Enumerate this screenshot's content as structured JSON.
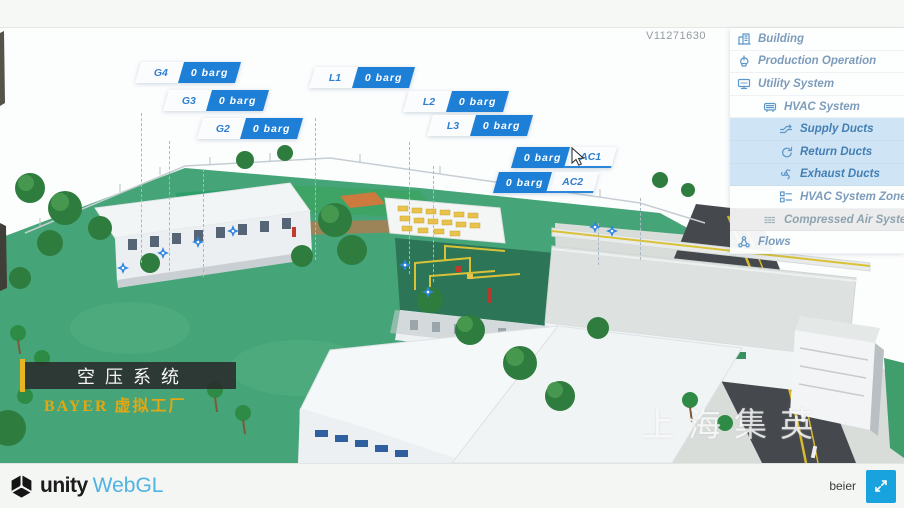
{
  "header": {
    "version": "V11271630"
  },
  "sidebar": {
    "items": [
      {
        "label": "Building",
        "icon": "building-icon",
        "level": 0,
        "active": false
      },
      {
        "label": "Production Operation",
        "icon": "production-operation-icon",
        "level": 0,
        "active": false
      },
      {
        "label": "Utility System",
        "icon": "utility-system-icon",
        "level": 0,
        "active": false
      },
      {
        "label": "HVAC System",
        "icon": "hvac-system-icon",
        "level": 1,
        "active": false
      },
      {
        "label": "Supply Ducts",
        "icon": "supply-ducts-icon",
        "level": 2,
        "active": true
      },
      {
        "label": "Return Ducts",
        "icon": "return-ducts-icon",
        "level": 2,
        "active": true
      },
      {
        "label": "Exhaust Ducts",
        "icon": "exhaust-ducts-icon",
        "level": 2,
        "active": true
      },
      {
        "label": "HVAC System Zones",
        "icon": "hvac-zones-icon",
        "level": 2,
        "active": false
      },
      {
        "label": "Compressed Air System",
        "icon": "compressed-air-icon",
        "level": 1,
        "active": false,
        "selected": true
      },
      {
        "label": "Flows",
        "icon": "flows-icon",
        "level": 0,
        "active": false
      }
    ]
  },
  "tags": [
    {
      "id": "G4",
      "value": "0 barg"
    },
    {
      "id": "G3",
      "value": "0 barg"
    },
    {
      "id": "G2",
      "value": "0 barg"
    },
    {
      "id": "L1",
      "value": "0 barg"
    },
    {
      "id": "L2",
      "value": "0 barg"
    },
    {
      "id": "L3",
      "value": "0 barg"
    },
    {
      "id": "AC1",
      "value": "0 barg"
    },
    {
      "id": "AC2",
      "value": "0 barg"
    }
  ],
  "banner": {
    "title": "空压系统",
    "subtitle": "BAYER 虚拟工厂"
  },
  "scene": {
    "watermark": "上海集英"
  },
  "footer": {
    "unity_label": "unity",
    "webgl_label": "WebGL",
    "user_label": "beier"
  },
  "colors": {
    "accent_blue": "#1e7fd6",
    "tag_text_blue": "#2e7fd0",
    "sidebar_highlight": "#cfe4f4",
    "selected_gray": "#ebeceb",
    "banner_gold": "#e2a714",
    "webgl_blue": "#4fb3e2",
    "button_blue": "#18a3de",
    "ground_green": "#46a578",
    "roof_green": "#2c7557",
    "pipe_yellow": "#d9c238"
  }
}
